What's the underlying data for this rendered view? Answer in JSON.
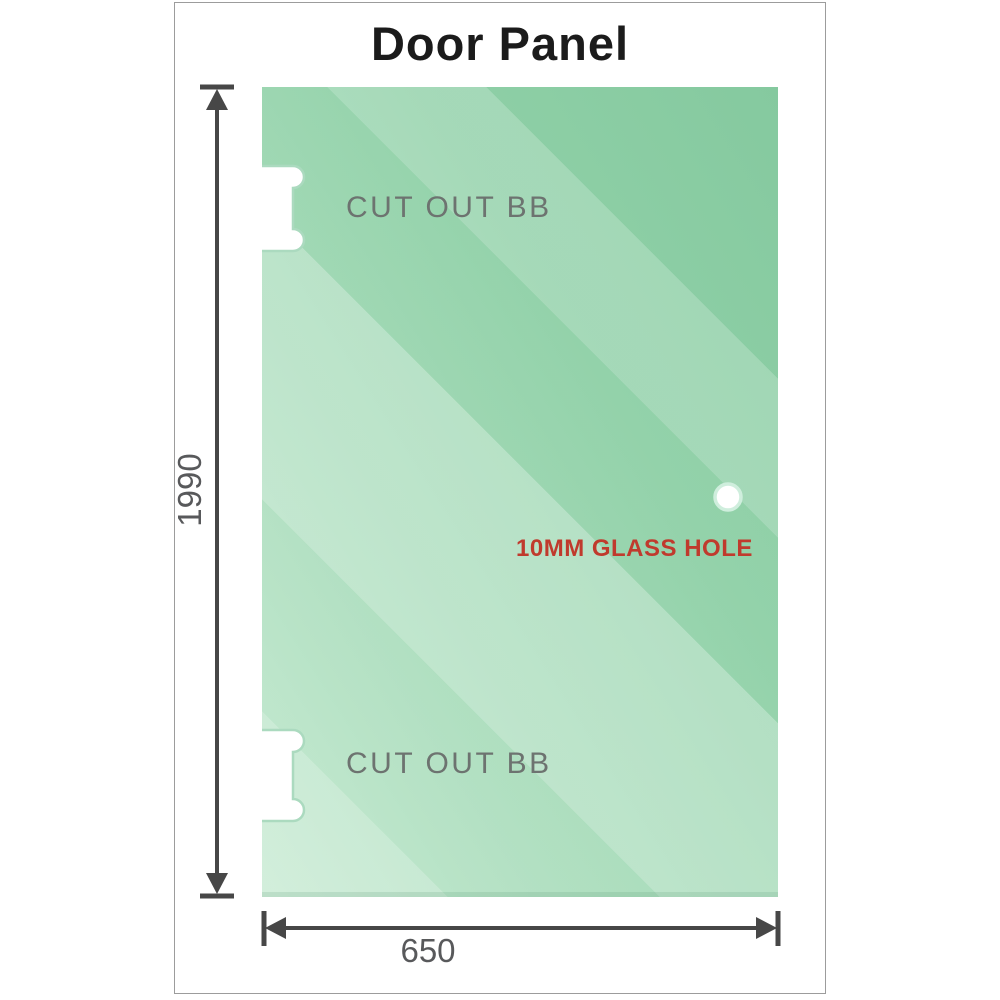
{
  "title": "Door Panel",
  "glass_panel": {
    "cutouts": [
      {
        "label": "CUT OUT BB",
        "position": "top-left"
      },
      {
        "label": "CUT OUT BB",
        "position": "bottom-left"
      }
    ],
    "hole": {
      "label": "10MM GLASS HOLE"
    }
  },
  "dimensions": {
    "height": {
      "value": "1990"
    },
    "width": {
      "value": "650"
    }
  },
  "colors": {
    "title_text": "#1b1b1b",
    "frame_border": "#9c9c9c",
    "glass_dark": "#85c99f",
    "glass_light": "#bfe7cc",
    "cutout_stroke": "#abdabf",
    "hole_ring": "#cfeedd",
    "dimension_line": "#474747",
    "dimension_text": "#58595b",
    "cutout_label_text": "#6d7370",
    "hole_label_text": "#c03a2d"
  }
}
